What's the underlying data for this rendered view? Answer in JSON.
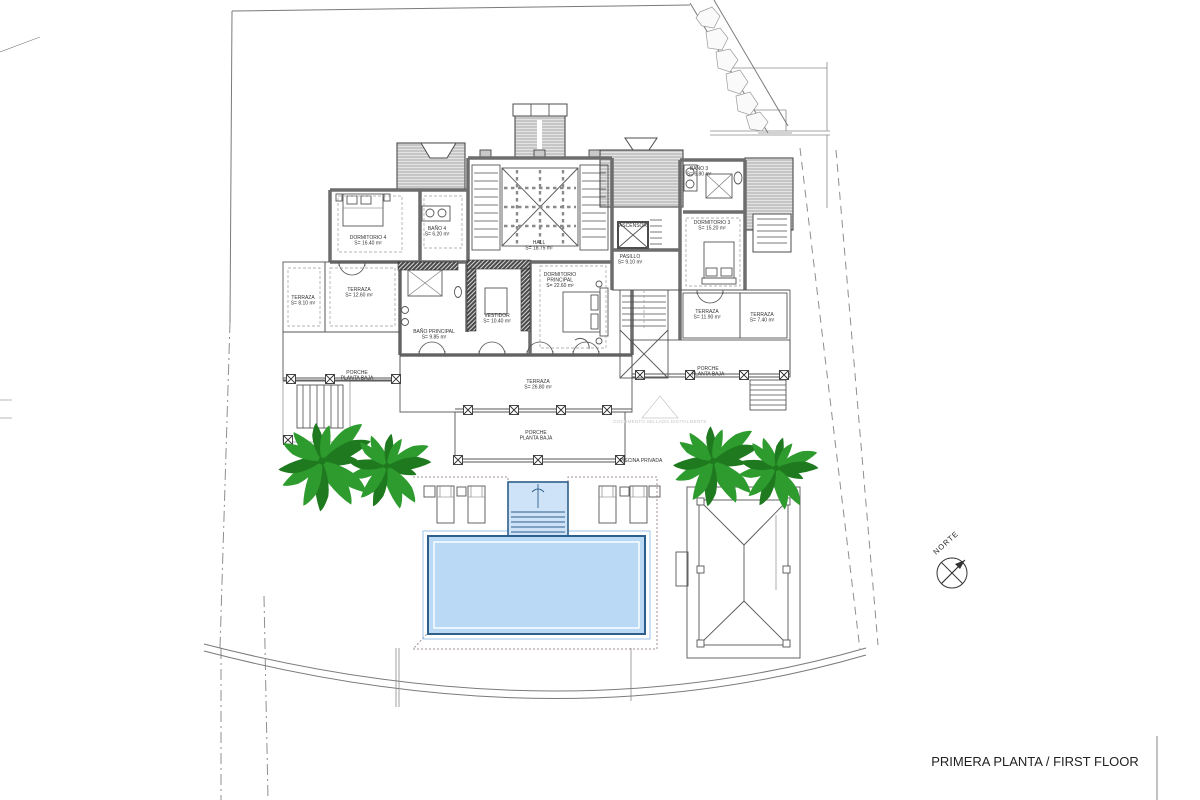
{
  "title": {
    "text": "PRIMERA PLANTA / FIRST FLOOR"
  },
  "compass": {
    "label": "NORTE"
  },
  "watermark": {
    "text": "DOCUMENTO SELLADO DIGITALMENTE"
  },
  "colors": {
    "pool_fill": "#b9d9f4",
    "pool_steps": "#cfe3f8",
    "pool_border": "#2e5f8a",
    "pool_ring": "#9cc3e8",
    "palm_green": "#2e9b2e",
    "palm_dark": "#1f7a1f",
    "watermark_gray": "#c6c6c6"
  },
  "rooms": [
    {
      "lines": [
        "DORMITORIO 4",
        "S= 16.40 m²"
      ],
      "x": 368,
      "y": 239
    },
    {
      "lines": [
        "BAÑO 4",
        "S= 6.20 m²"
      ],
      "x": 437,
      "y": 230
    },
    {
      "lines": [
        "HALL",
        "S= 18.75 m²"
      ],
      "x": 539,
      "y": 244
    },
    {
      "lines": [
        "BAÑO 3",
        "S= 6.80 m²"
      ],
      "x": 699,
      "y": 170
    },
    {
      "lines": [
        "ASCENSOR"
      ],
      "x": 633,
      "y": 227
    },
    {
      "lines": [
        "PASILLO",
        "S= 9.10 m²"
      ],
      "x": 630,
      "y": 258
    },
    {
      "lines": [
        "DORMITORIO 3",
        "S= 15.20 m²"
      ],
      "x": 712,
      "y": 224
    },
    {
      "lines": [
        "BAÑO PRINCIPAL",
        "S= 9.85 m²"
      ],
      "x": 434,
      "y": 333
    },
    {
      "lines": [
        "VESTIDOR",
        "S= 10.40 m²"
      ],
      "x": 497,
      "y": 317
    },
    {
      "lines": [
        "DORMITORIO",
        "PRINCIPAL",
        "S= 22.60 m²"
      ],
      "x": 560,
      "y": 276
    },
    {
      "lines": [
        "TERRAZA",
        "S= 8.10 m²"
      ],
      "x": 303,
      "y": 299
    },
    {
      "lines": [
        "TERRAZA",
        "S= 12.60 m²"
      ],
      "x": 359,
      "y": 291
    },
    {
      "lines": [
        "TERRAZA",
        "S= 11.90 m²"
      ],
      "x": 707,
      "y": 313
    },
    {
      "lines": [
        "TERRAZA",
        "S= 7.40 m²"
      ],
      "x": 762,
      "y": 316
    },
    {
      "lines": [
        "TERRAZA",
        "S= 26.80 m²"
      ],
      "x": 538,
      "y": 383
    },
    {
      "lines": [
        "PORCHE",
        "PLANTA BAJA"
      ],
      "x": 357,
      "y": 374
    },
    {
      "lines": [
        "PORCHE",
        "PLANTA BAJA"
      ],
      "x": 536,
      "y": 434
    },
    {
      "lines": [
        "PORCHE",
        "PLANTA BAJA"
      ],
      "x": 708,
      "y": 370
    },
    {
      "lines": [
        "PISCINA PRIVADA"
      ],
      "x": 641,
      "y": 462
    }
  ],
  "landscape": {
    "palms": [
      {
        "x": 322,
        "y": 461,
        "r": 52
      },
      {
        "x": 387,
        "y": 466,
        "r": 44
      },
      {
        "x": 713,
        "y": 461,
        "r": 47
      },
      {
        "x": 776,
        "y": 468,
        "r": 42
      }
    ]
  }
}
